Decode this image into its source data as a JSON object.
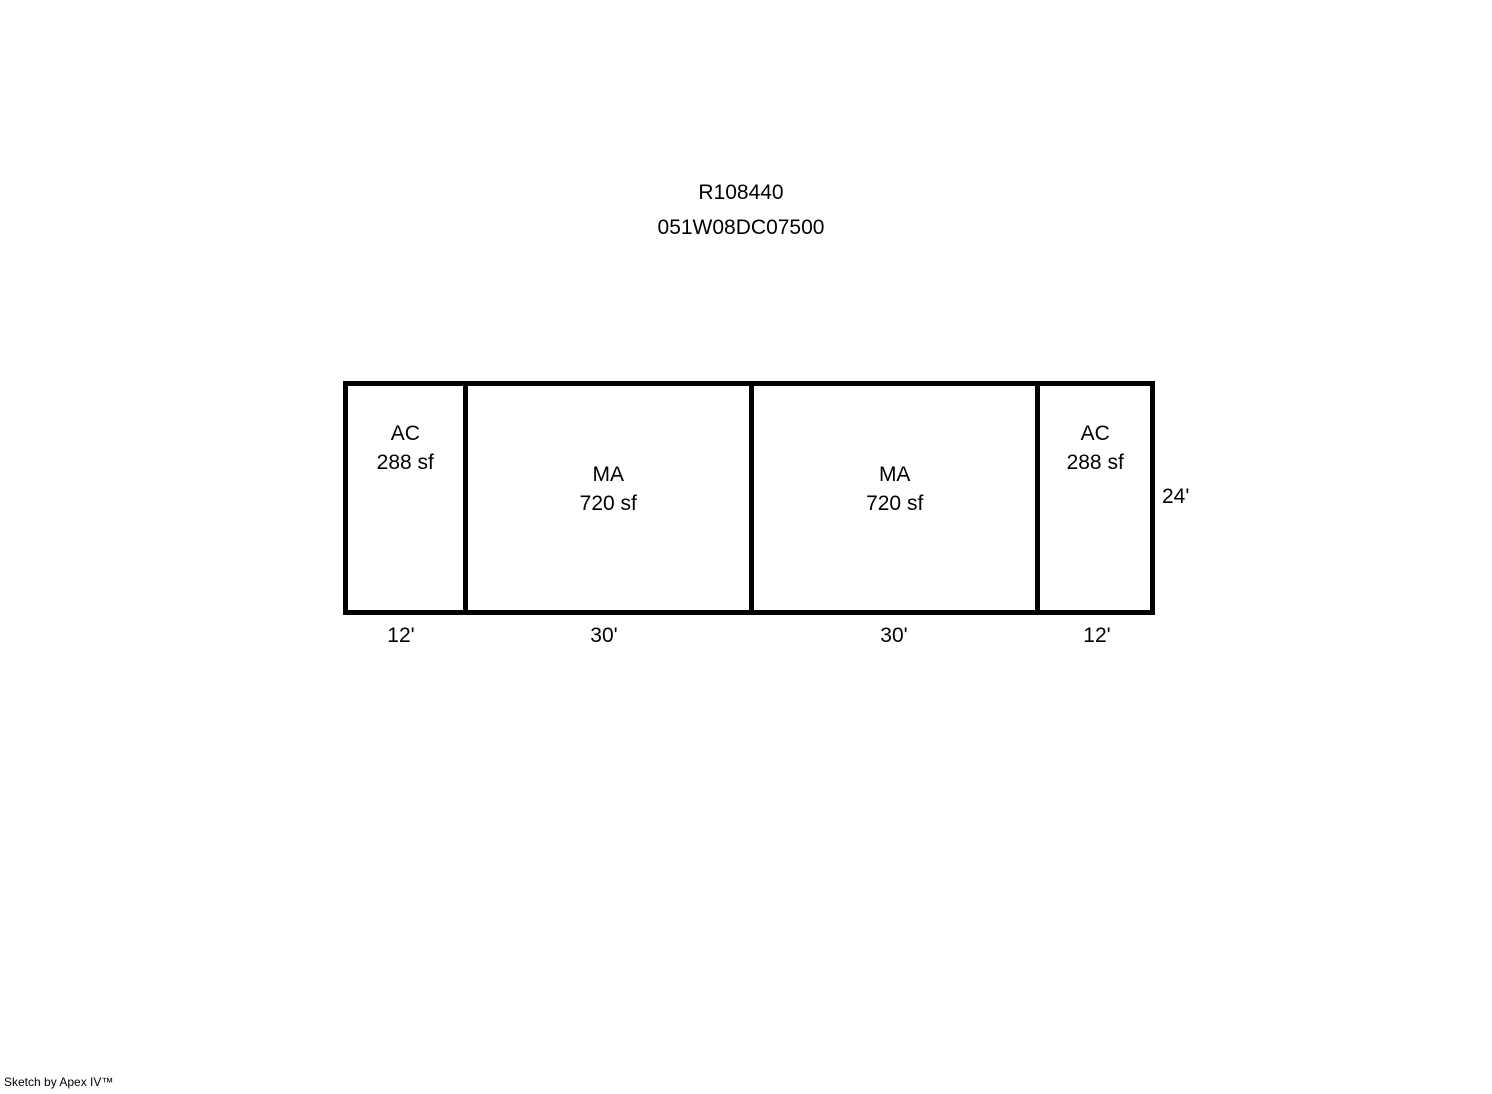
{
  "colors": {
    "ink": "#000000",
    "background": "#ffffff"
  },
  "header": {
    "property_id": "R108440",
    "parcel_number": "051W08DC07500"
  },
  "sketch": {
    "height_label": "24'",
    "height_ft": 24,
    "sections": [
      {
        "code": "AC",
        "area": "288 sf",
        "width_label": "12'",
        "width_ft": 12
      },
      {
        "code": "MA",
        "area": "720 sf",
        "width_label": "30'",
        "width_ft": 30
      },
      {
        "code": "MA",
        "area": "720 sf",
        "width_label": "30'",
        "width_ft": 30
      },
      {
        "code": "AC",
        "area": "288 sf",
        "width_label": "12'",
        "width_ft": 12
      }
    ]
  },
  "footer": {
    "credit": "Sketch by Apex IV™"
  }
}
